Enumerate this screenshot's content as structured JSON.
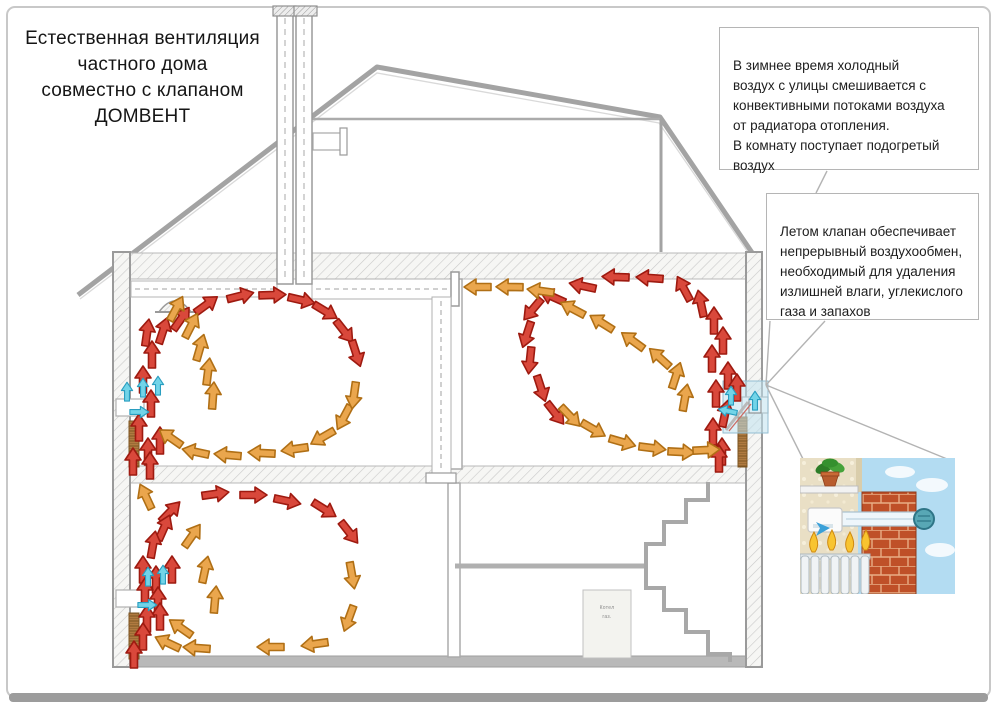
{
  "title": {
    "lines": [
      "Естественная вентиляция",
      "частного дома",
      "совместно с клапаном",
      "ДОМВЕНТ"
    ]
  },
  "callouts": {
    "winter": {
      "text": "В зимнее время      холодный\nвоздух с улицы смешивается с\nконвективными потоками воздуха\nот радиатора отопления.\nВ комнату поступает подогретый\nвоздух"
    },
    "summer": {
      "text": "Летом клапан обеспечивает\nнепрерывный воздухообмен,\nнеобходимый для удаления\nизлишней влаги, углекислого\nгаза и запахов"
    }
  },
  "equipment_label": {
    "lines": [
      "Котел",
      "газ."
    ]
  },
  "icons": {
    "ceiling-lamp": "bell-shape-grille",
    "exhaust-grille": "duct-flange",
    "plant": "potted-plant",
    "radiator": "finned-radiator",
    "valve": "domvent-wall-valve"
  },
  "colors": {
    "red": "#d9483b",
    "red_stroke": "#9e1a10",
    "orange": "#eaa64d",
    "orange_stroke": "#b06f15",
    "cyan": "#72d4e8",
    "cyan_stroke": "#2a9ec0",
    "wall_gray": "#a8a8a8",
    "radiator_brown": "#ad763c",
    "valve_highlight": "#bfe2ef",
    "sky": "#b3dcf2",
    "brick": "#bf5028"
  },
  "arrows": {
    "room_upper_left": [
      [
        148,
        452,
        -90,
        "r"
      ],
      [
        139,
        428,
        -90,
        "r"
      ],
      [
        151,
        404,
        -90,
        "r"
      ],
      [
        143,
        380,
        -90,
        "r"
      ],
      [
        152,
        355,
        -90,
        "r"
      ],
      [
        147,
        333,
        -82,
        "r"
      ],
      [
        163,
        331,
        -72,
        "r"
      ],
      [
        181,
        319,
        -55,
        "r"
      ],
      [
        206,
        305,
        -36,
        "r"
      ],
      [
        240,
        296,
        -14,
        "r"
      ],
      [
        272,
        295,
        -2,
        "r"
      ],
      [
        301,
        300,
        13,
        "r"
      ],
      [
        325,
        311,
        31,
        "r"
      ],
      [
        344,
        331,
        52,
        "r"
      ],
      [
        356,
        353,
        72,
        "r"
      ],
      [
        133,
        462,
        -90,
        "r"
      ],
      [
        150,
        466,
        -90,
        "r"
      ],
      [
        160,
        441,
        -90,
        "r"
      ],
      [
        176,
        309,
        -62,
        "o"
      ],
      [
        191,
        326,
        -63,
        "o"
      ],
      [
        200,
        348,
        -74,
        "o"
      ],
      [
        208,
        372,
        -83,
        "o"
      ],
      [
        213,
        396,
        -86,
        "o"
      ],
      [
        171,
        438,
        215,
        "o"
      ],
      [
        196,
        452,
        192,
        "o"
      ],
      [
        228,
        455,
        185,
        "o"
      ],
      [
        262,
        453,
        183,
        "o"
      ],
      [
        295,
        449,
        172,
        "o"
      ],
      [
        323,
        437,
        150,
        "o"
      ],
      [
        344,
        417,
        118,
        "o"
      ],
      [
        354,
        395,
        98,
        "o"
      ],
      [
        139,
        412,
        0,
        "c",
        0.7
      ],
      [
        127,
        392,
        -90,
        "c",
        0.7
      ],
      [
        143,
        388,
        -90,
        "c",
        0.7
      ],
      [
        158,
        386,
        -90,
        "c",
        0.7
      ]
    ],
    "room_upper_right": [
      [
        722,
        452,
        -90,
        "r"
      ],
      [
        713,
        432,
        -90,
        "r"
      ],
      [
        725,
        414,
        -78,
        "r"
      ],
      [
        716,
        394,
        -90,
        "r"
      ],
      [
        728,
        376,
        -90,
        "r"
      ],
      [
        712,
        359,
        -90,
        "r"
      ],
      [
        723,
        341,
        -90,
        "r"
      ],
      [
        714,
        321,
        -90,
        "r"
      ],
      [
        701,
        304,
        -102,
        "r"
      ],
      [
        684,
        289,
        -118,
        "r"
      ],
      [
        650,
        278,
        184,
        "r"
      ],
      [
        616,
        277,
        182,
        "r"
      ],
      [
        583,
        286,
        192,
        "r"
      ],
      [
        553,
        297,
        204,
        "r"
      ],
      [
        533,
        309,
        130,
        "r"
      ],
      [
        527,
        334,
        108,
        "r"
      ],
      [
        530,
        360,
        96,
        "r"
      ],
      [
        541,
        388,
        72,
        "r"
      ],
      [
        555,
        413,
        52,
        "r"
      ],
      [
        737,
        388,
        -90,
        "r"
      ],
      [
        719,
        459,
        -90,
        "r"
      ],
      [
        478,
        287,
        180,
        "o"
      ],
      [
        510,
        287,
        181,
        "o"
      ],
      [
        541,
        291,
        188,
        "o"
      ],
      [
        573,
        309,
        -152,
        "o"
      ],
      [
        602,
        323,
        -148,
        "o"
      ],
      [
        633,
        341,
        -144,
        "o"
      ],
      [
        660,
        358,
        -138,
        "o"
      ],
      [
        676,
        376,
        -72,
        "o"
      ],
      [
        685,
        398,
        -80,
        "o"
      ],
      [
        570,
        416,
        46,
        "o"
      ],
      [
        593,
        429,
        30,
        "o"
      ],
      [
        622,
        442,
        16,
        "o"
      ],
      [
        652,
        448,
        7,
        "o"
      ],
      [
        681,
        452,
        3,
        "o"
      ],
      [
        706,
        450,
        -3,
        "o"
      ],
      [
        731,
        396,
        -90,
        "c",
        0.7
      ],
      [
        728,
        411,
        192,
        "c",
        0.7
      ],
      [
        755,
        401,
        -90,
        "c",
        0.7
      ]
    ],
    "room_lower_left": [
      [
        143,
        570,
        -90,
        "r"
      ],
      [
        156,
        580,
        -90,
        "r"
      ],
      [
        172,
        570,
        -90,
        "r"
      ],
      [
        145,
        592,
        -90,
        "r"
      ],
      [
        158,
        601,
        -90,
        "r"
      ],
      [
        160,
        617,
        -90,
        "r"
      ],
      [
        147,
        619,
        -90,
        "r"
      ],
      [
        143,
        637,
        -90,
        "r"
      ],
      [
        134,
        655,
        -90,
        "r"
      ],
      [
        170,
        512,
        -46,
        "r"
      ],
      [
        164,
        528,
        -66,
        "r"
      ],
      [
        153,
        545,
        -80,
        "r"
      ],
      [
        215,
        494,
        -8,
        "r"
      ],
      [
        253,
        495,
        0,
        "r"
      ],
      [
        287,
        501,
        12,
        "r"
      ],
      [
        324,
        509,
        32,
        "r"
      ],
      [
        349,
        532,
        52,
        "r"
      ],
      [
        146,
        497,
        -115,
        "o"
      ],
      [
        192,
        536,
        -55,
        "o"
      ],
      [
        205,
        570,
        -78,
        "o"
      ],
      [
        215,
        600,
        -85,
        "o"
      ],
      [
        352,
        575,
        80,
        "o"
      ],
      [
        349,
        618,
        110,
        "o"
      ],
      [
        315,
        644,
        172,
        "o"
      ],
      [
        271,
        647,
        180,
        "o"
      ],
      [
        197,
        648,
        184,
        "o"
      ],
      [
        168,
        643,
        205,
        "o"
      ],
      [
        181,
        628,
        215,
        "o"
      ],
      [
        147,
        605,
        0,
        "c",
        0.7
      ],
      [
        148,
        577,
        -90,
        "c",
        0.7
      ],
      [
        163,
        575,
        -90,
        "c",
        0.7
      ]
    ]
  }
}
